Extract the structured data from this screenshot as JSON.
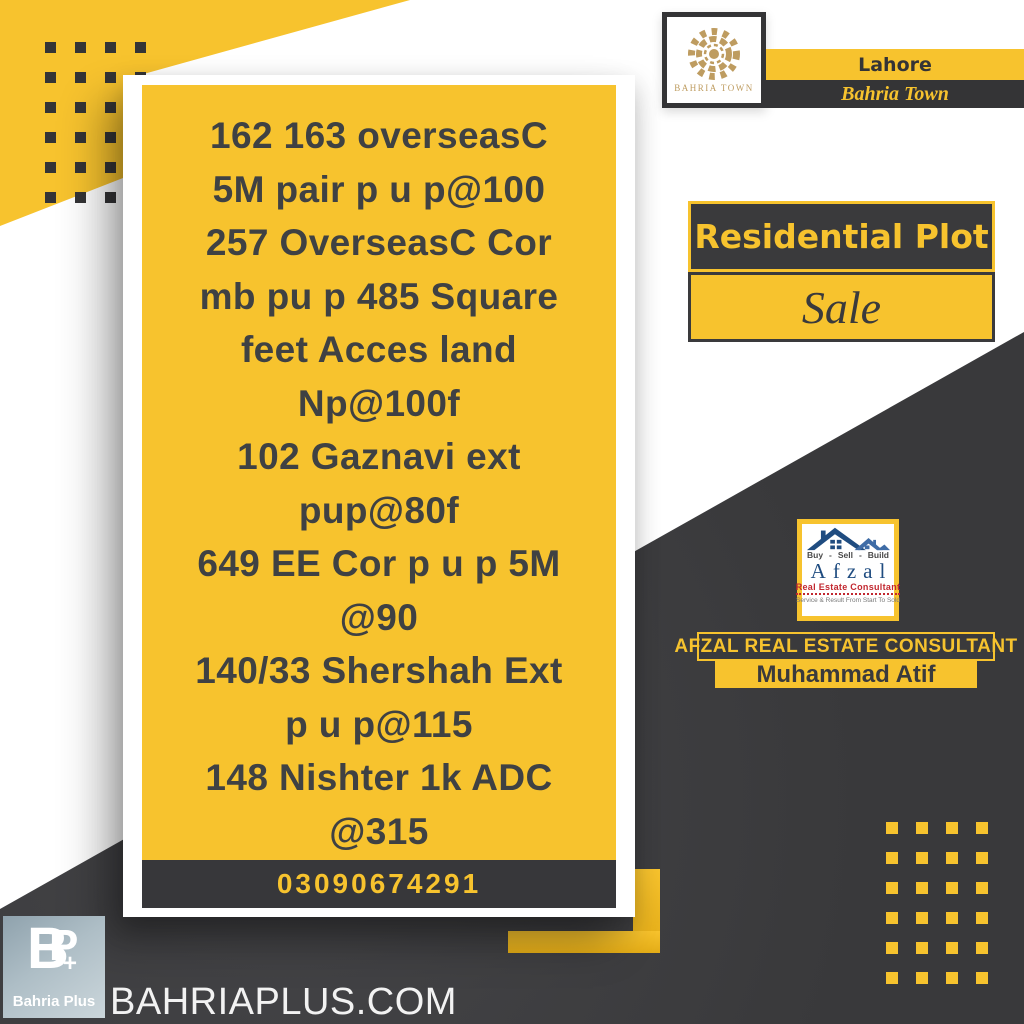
{
  "colors": {
    "yellow": "#F7C32E",
    "dark": "#3A3A3C",
    "gold": "#BE9C60",
    "navy": "#1F4C80",
    "red": "#C2272F"
  },
  "card": {
    "lines": [
      "162 163 overseasC",
      "5M pair p u p@100",
      "257 OverseasC Cor",
      "mb pu p 485 Square",
      "feet Acces land",
      "Np@100f",
      "102 Gaznavi ext",
      "pup@80f",
      "649 EE Cor p u p 5M",
      "@90",
      "140/33 Shershah Ext",
      "p u p@115",
      "148 Nishter 1k ADC",
      "@315"
    ],
    "phone": "03090674291"
  },
  "brand": {
    "logo_caption": "BAHRIA TOWN",
    "city": "Lahore",
    "name": "Bahria Town"
  },
  "listing": {
    "type": "Residential Plot",
    "status": "Sale"
  },
  "agent": {
    "ribbon": "AFZAL REAL ESTATE CONSULTANT",
    "name": "Muhammad Atif",
    "logo": {
      "words": [
        "Buy",
        "Sell",
        "Build"
      ],
      "separator": "-",
      "title": "Afzal",
      "subtitle": "Real Estate Consultant",
      "tagline": "Service & Result From Start To Sold"
    }
  },
  "footer": {
    "site": "BAHRIAPLUS.COM",
    "logo": {
      "letter_b": "B",
      "letter_p": "P",
      "plus": "+",
      "label": "Bahria Plus"
    }
  }
}
